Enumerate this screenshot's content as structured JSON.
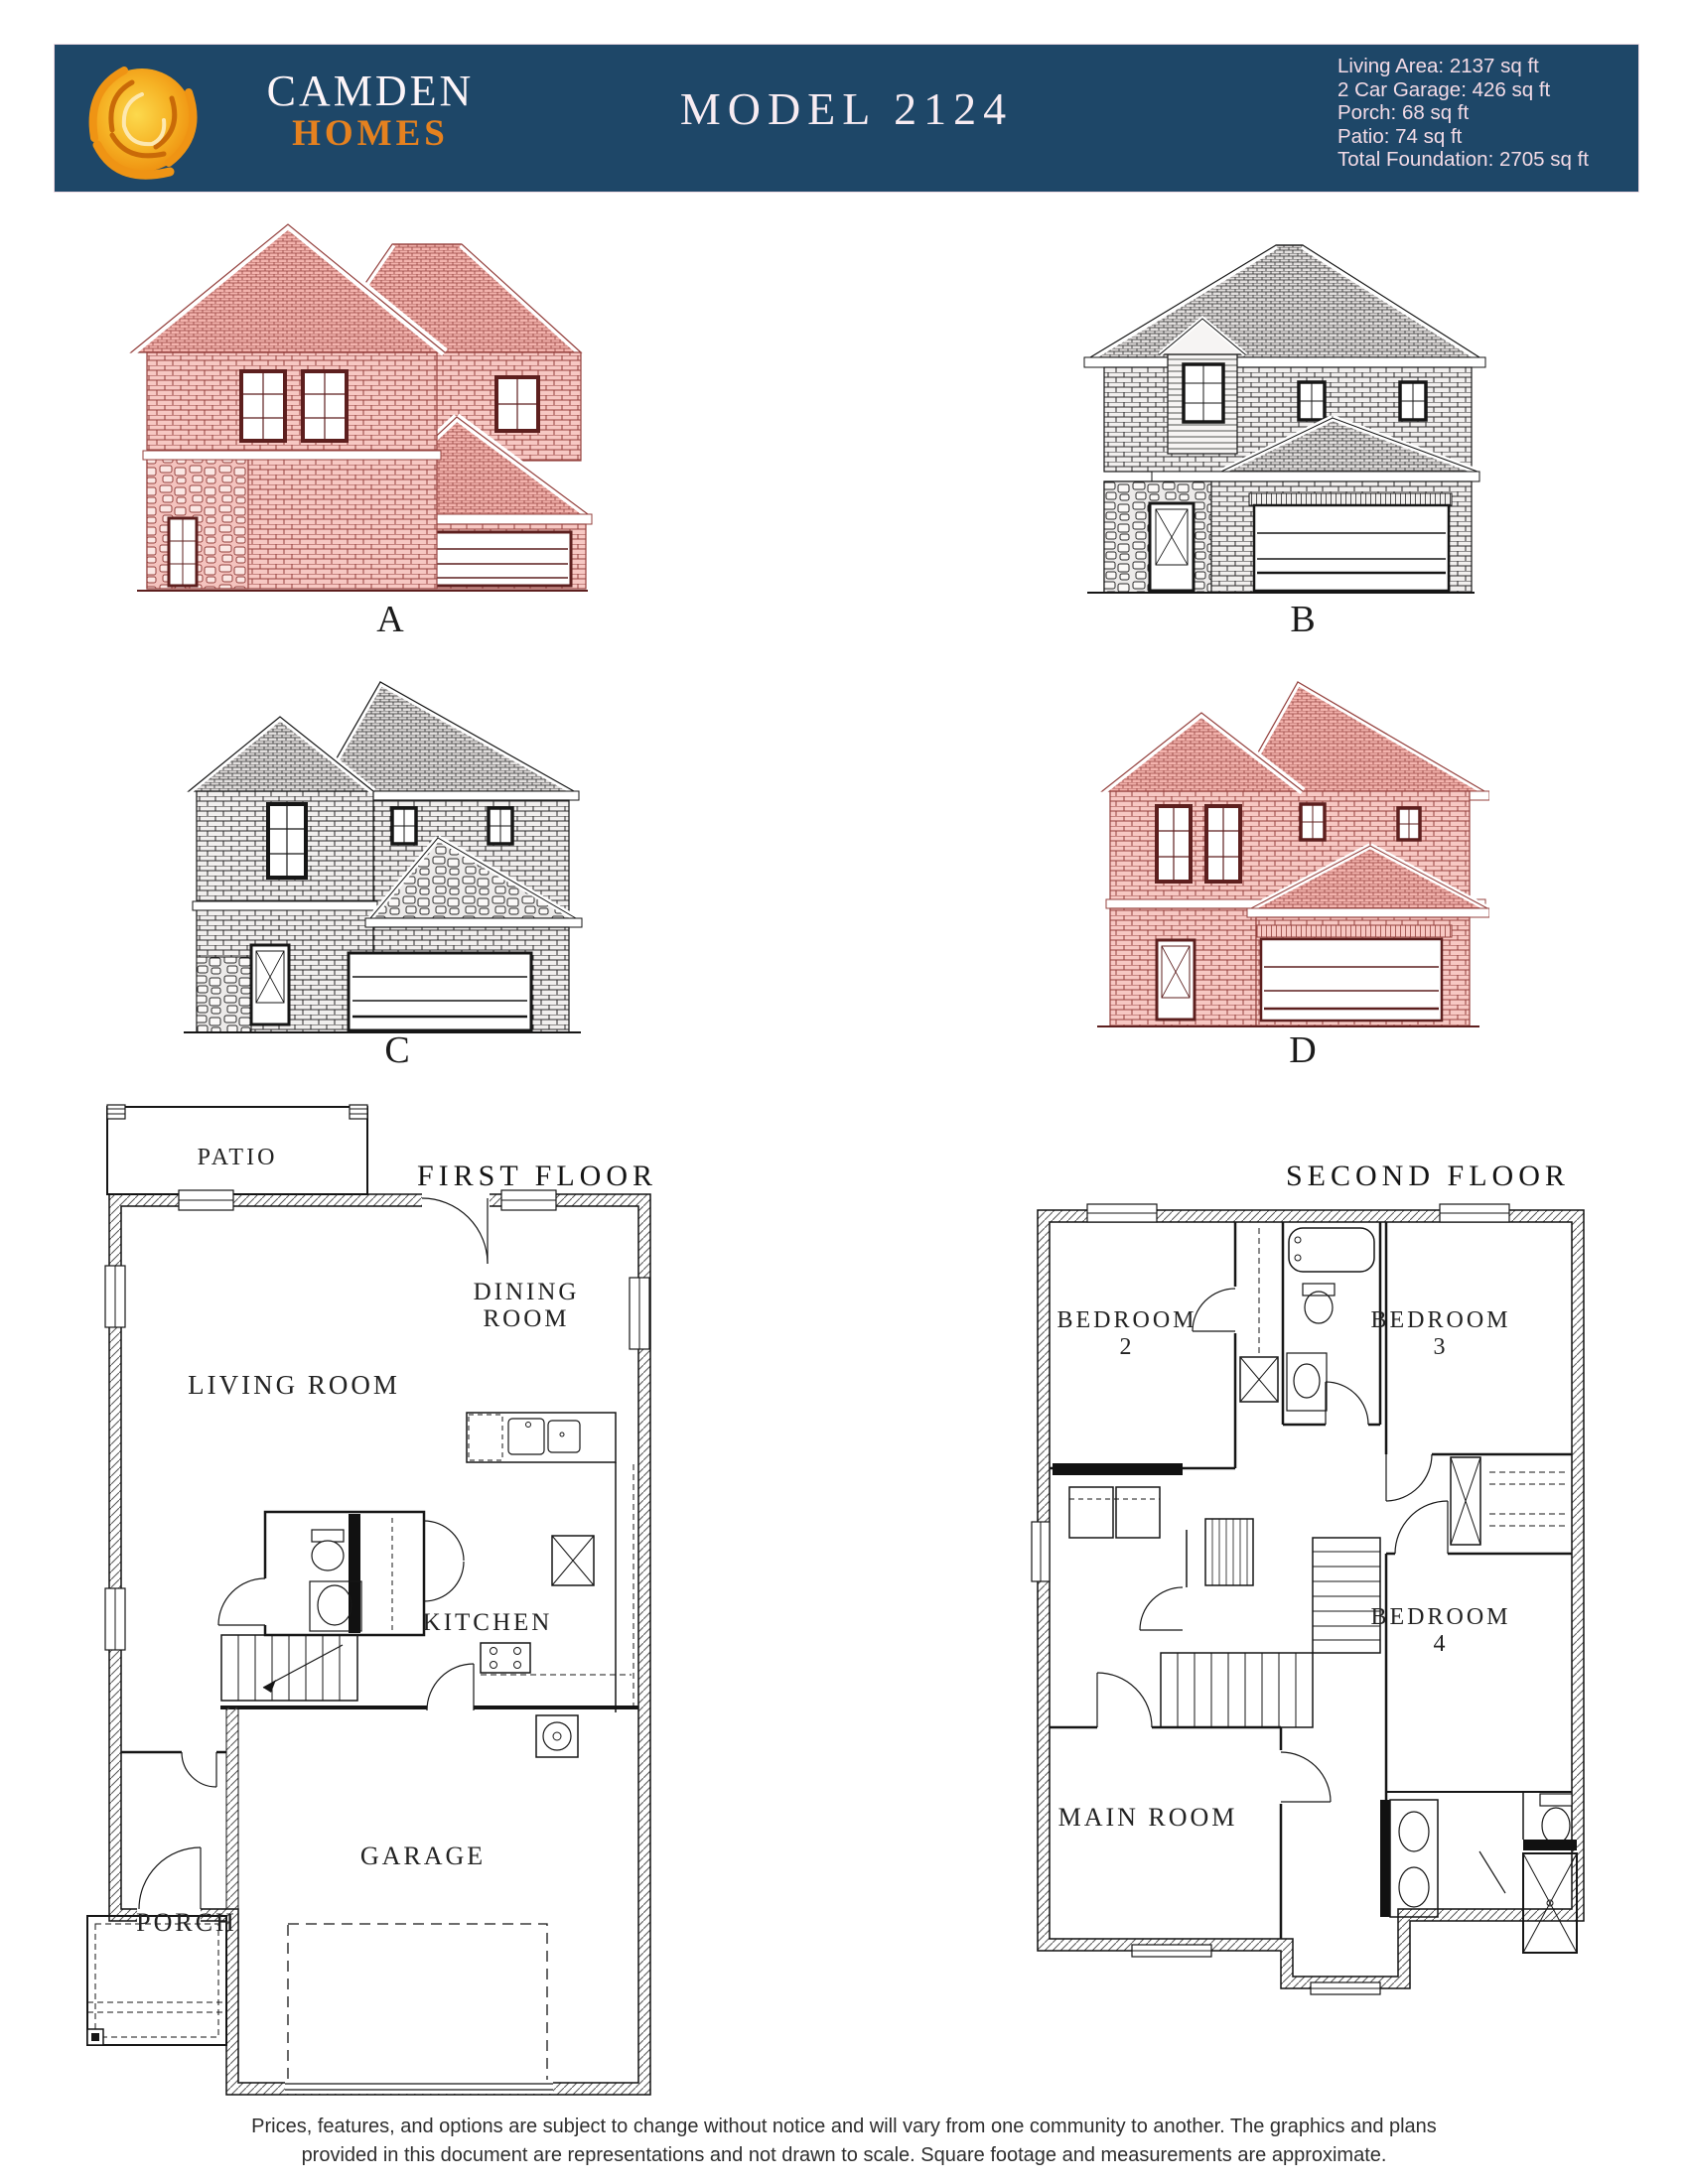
{
  "header": {
    "band_color": "#1e4768",
    "logo_icon": "sun-swirl-icon",
    "brand_line1": "CAMDEN",
    "brand_line2": "HOMES",
    "brand_accent_color": "#e5811f",
    "title": "MODEL 2124",
    "stats": [
      "Living Area: 2137 sq ft",
      "2 Car Garage: 426 sq ft",
      "Porch: 68 sq ft",
      "Patio: 74 sq ft",
      "Total Foundation: 2705 sq ft"
    ]
  },
  "elevations": {
    "a": "A",
    "b": "B",
    "c": "C",
    "d": "D",
    "brick_color": "#8e3533",
    "line_color": "#1c1c1c"
  },
  "first_floor": {
    "title": "FIRST FLOOR",
    "patio": "PATIO",
    "living_room": "LIVING ROOM",
    "dining_line1": "DINING",
    "dining_line2": "ROOM",
    "kitchen": "KITCHEN",
    "garage": "GARAGE",
    "porch": "PORCH"
  },
  "second_floor": {
    "title": "SECOND FLOOR",
    "bedroom_label": "BEDROOM",
    "bedroom2_number": "2",
    "bedroom3_number": "3",
    "bedroom4_number": "4",
    "main_room": "MAIN ROOM"
  },
  "footer": {
    "line1": "Prices, features, and options are subject to change without notice and will vary from one community to another. The graphics and plans",
    "line2": "provided in this document are representations and not drawn to scale. Square footage and measurements are approximate."
  }
}
